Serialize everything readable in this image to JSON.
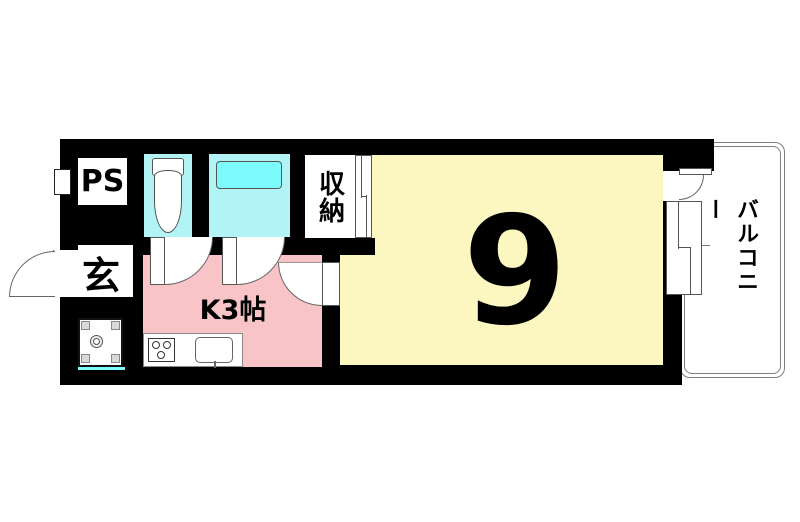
{
  "floorplan": {
    "type": "apartment-1K-floor-plan",
    "rooms": {
      "pipe_space": {
        "label": "PS"
      },
      "entrance": {
        "label": "玄"
      },
      "kitchen": {
        "label": "K3帖"
      },
      "main_room": {
        "label": "9"
      },
      "storage": {
        "label": "収納"
      },
      "balcony": {
        "label": "バルコニー"
      }
    },
    "fixtures": [
      "toilet",
      "bathtub",
      "stove-burners",
      "kitchen-sink",
      "washing-machine-pan",
      "sliding-window",
      "hinged-doors"
    ],
    "colors": {
      "wall": "#000000",
      "main_room_fill": "#fcf7c0",
      "kitchen_fill": "#f8c4c8",
      "wet_area_fill": "#b2f3f5",
      "bathtub_fill": "#7dfbfc",
      "outline_gray": "#666666",
      "balcony_line": "#7f7f7f"
    }
  }
}
